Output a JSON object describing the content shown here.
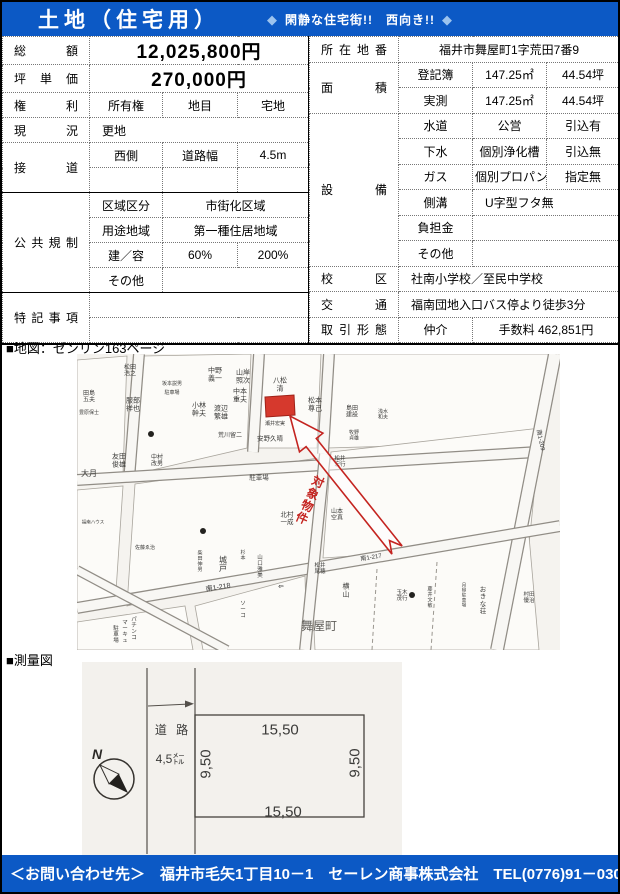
{
  "colors": {
    "banner": "#0c59c5",
    "tagline_diamond": "#9cc3ee",
    "highlight_red": "#d6392d",
    "arrow_red": "#c42420"
  },
  "header": {
    "title": "土地（住宅用）",
    "diamond_left": "◆",
    "tagline": "閑静な住宅街!!　西向き!!",
    "diamond_right": "◆"
  },
  "left_table": {
    "price_label": "総額",
    "price": "12,025,800円",
    "unit_label": "坪単価",
    "unit": "270,000円",
    "rights_label": "権利",
    "rights": "所有権",
    "landcat_label": "地目",
    "landcat": "宅地",
    "status_label": "現況",
    "status": "更地",
    "road_label": "接道",
    "road_side": "西側",
    "road_width_label": "道路幅",
    "road_width": "4.5m",
    "regulation_label": "公共規制",
    "zoning_label": "区域区分",
    "zoning": "市街化区域",
    "use_label": "用途地域",
    "use": "第一種住居地域",
    "bcr_far_label": "建／容",
    "bcr": "60%",
    "far": "200%",
    "other_label": "その他",
    "notes_label": "特記事項"
  },
  "right_table": {
    "address_label": "所在地番",
    "address": "福井市舞屋町1字荒田7番9",
    "area_label": "面積",
    "registered_label": "登記簿",
    "registered_m2": "147.25㎡",
    "registered_tsubo": "44.54坪",
    "measured_label": "実測",
    "measured_m2": "147.25㎡",
    "measured_tsubo": "44.54坪",
    "facilities_label": "設備",
    "water_label": "水道",
    "water": "公営",
    "water_status": "引込有",
    "sewer_label": "下水",
    "sewer": "個別浄化槽",
    "sewer_status": "引込無",
    "gas_label": "ガス",
    "gas": "個別プロパン",
    "gas_status": "指定無",
    "gutter_label": "側溝",
    "gutter": "U字型フタ無",
    "burden_label": "負担金",
    "other_label": "その他",
    "school_label": "校区",
    "school": "社南小学校／至民中学校",
    "transit_label": "交通",
    "transit": "福南団地入口バス停より徒歩3分",
    "deal_label": "取引形態",
    "deal_type": "仲介",
    "fee": "手数料 462,851円"
  },
  "map_section": {
    "heading": "■地図：ゼンリン163ページ",
    "map": {
      "bg": "#f5f3ef",
      "blocks": [
        [
          0,
          6,
          50,
          2,
          46,
          120,
          0,
          128
        ],
        [
          66,
          2,
          174,
          0,
          170,
          94,
          58,
          120
        ],
        [
          186,
          0,
          244,
          0,
          240,
          94,
          178,
          94
        ],
        [
          256,
          0,
          472,
          0,
          458,
          88,
          250,
          94
        ],
        [
          0,
          136,
          46,
          132,
          38,
          252,
          0,
          258
        ],
        [
          58,
          130,
          242,
          104,
          236,
          208,
          50,
          252
        ],
        [
          254,
          98,
          464,
          74,
          452,
          190,
          246,
          204
        ],
        [
          234,
          214,
          452,
          182,
          462,
          296,
          238,
          296
        ],
        [
          118,
          252,
          228,
          222,
          230,
          296,
          126,
          296
        ],
        [
          0,
          268,
          108,
          252,
          116,
          296,
          0,
          296
        ]
      ],
      "roads": [
        [
          62,
          0,
          52,
          126
        ],
        [
          182,
          0,
          176,
          98
        ],
        [
          252,
          0,
          246,
          100
        ],
        [
          0,
          126,
          460,
          98
        ],
        [
          478,
          0,
          420,
          296,
          14
        ],
        [
          0,
          254,
          483,
          172
        ],
        [
          248,
          100,
          228,
          296
        ],
        [
          0,
          216,
          150,
          296,
          10
        ]
      ],
      "dashes": [
        [
          300,
          215,
          295,
          296
        ],
        [
          360,
          208,
          354,
          296
        ]
      ],
      "dots": [
        [
          74,
          80
        ],
        [
          126,
          177
        ],
        [
          335,
          241
        ]
      ],
      "parcel": [
        188,
        43,
        217,
        41,
        218,
        61,
        189,
        63
      ],
      "arrow_points": "213,62 222.5,97.9 229.1,92.6 314.9,200.1 312.5,186.6 325.1,191.9 239.3,84.5 245.9,79.2",
      "arrow_label": {
        "t": "対象物件",
        "x": 233,
        "y": 146,
        "r": 24,
        "s": 12
      },
      "labels": [
        {
          "t": "松田\n浩之",
          "x": 53,
          "y": 16,
          "s": 6
        },
        {
          "t": "坂本説男",
          "x": 95,
          "y": 29,
          "s": 5
        },
        {
          "t": "田島\n五夫",
          "x": 12,
          "y": 42,
          "s": 6
        },
        {
          "t": "服部\n祥也",
          "x": 56,
          "y": 50,
          "s": 7
        },
        {
          "t": "豊原保士",
          "x": 12,
          "y": 58,
          "s": 5
        },
        {
          "t": "駐車場",
          "x": 95,
          "y": 38,
          "s": 5
        },
        {
          "t": "中野\n義一",
          "x": 138,
          "y": 20,
          "s": 7
        },
        {
          "t": "山岸\n照次",
          "x": 166,
          "y": 22,
          "s": 7
        },
        {
          "t": "中本\n重夫",
          "x": 163,
          "y": 41,
          "s": 7
        },
        {
          "t": "小林\n幹夫",
          "x": 122,
          "y": 55,
          "s": 7
        },
        {
          "t": "渡辺\n繁雄",
          "x": 144,
          "y": 58,
          "s": 7
        },
        {
          "t": "荒川留二",
          "x": 153,
          "y": 81,
          "s": 6
        },
        {
          "t": "八松\n清",
          "x": 203,
          "y": 30,
          "s": 7
        },
        {
          "t": "松本\n尊己",
          "x": 238,
          "y": 50,
          "s": 7
        },
        {
          "t": "瀬井宏実",
          "x": 198,
          "y": 69,
          "s": 5
        },
        {
          "t": "安野久晴",
          "x": 193,
          "y": 84,
          "s": 6.5
        },
        {
          "t": "島田\n建設",
          "x": 275,
          "y": 57,
          "s": 6
        },
        {
          "t": "浅水\n和夫",
          "x": 306,
          "y": 60,
          "s": 5
        },
        {
          "t": "牧野\n貞雄",
          "x": 277,
          "y": 81,
          "s": 5
        },
        {
          "t": "松井\n宏行",
          "x": 263,
          "y": 107,
          "s": 5.5
        },
        {
          "t": "友田\n俊雄",
          "x": 42,
          "y": 106,
          "s": 7
        },
        {
          "t": "中村\n改男",
          "x": 80,
          "y": 106,
          "s": 6
        },
        {
          "t": "大月",
          "x": 12,
          "y": 119,
          "s": 8
        },
        {
          "t": "駐車場",
          "x": 182,
          "y": 123,
          "s": 6.5
        },
        {
          "t": "山本\n空真",
          "x": 260,
          "y": 160,
          "s": 6
        },
        {
          "t": "北村\n一成",
          "x": 210,
          "y": 164,
          "s": 6.5
        },
        {
          "t": "福南ハウス",
          "x": 16,
          "y": 168,
          "s": 4.5
        },
        {
          "t": "佐藤ゑ治",
          "x": 68,
          "y": 193,
          "s": 5
        },
        {
          "t": "柴田伸男",
          "x": 123,
          "y": 207,
          "s": 5,
          "v": true
        },
        {
          "t": "城戸",
          "x": 146,
          "y": 210,
          "s": 8,
          "v": true
        },
        {
          "t": "杉本",
          "x": 166,
          "y": 201,
          "s": 5,
          "v": true
        },
        {
          "t": "山口雅美",
          "x": 183,
          "y": 212,
          "s": 5.5,
          "v": true
        },
        {
          "t": "松井\n尾穂",
          "x": 243,
          "y": 214,
          "s": 5.5
        },
        {
          "t": "横山",
          "x": 269,
          "y": 236,
          "s": 7,
          "v": true
        },
        {
          "t": "玉木\n茂行",
          "x": 325,
          "y": 241,
          "s": 5.5
        },
        {
          "t": "藤井文敏",
          "x": 353,
          "y": 243,
          "s": 5,
          "v": true
        },
        {
          "t": "月極駐車場",
          "x": 387,
          "y": 241,
          "s": 4.5,
          "v": true
        },
        {
          "t": "おきな荘",
          "x": 406,
          "y": 246,
          "s": 6.5,
          "v": true
        },
        {
          "t": "村田\n優治",
          "x": 452,
          "y": 243,
          "s": 5.5
        },
        {
          "t": "舞屋町",
          "x": 242,
          "y": 272,
          "s": 12,
          "c": "#5f5d59"
        },
        {
          "t": "南1-218",
          "x": 141,
          "y": 233,
          "s": 7,
          "r": -9,
          "c": "#333333"
        },
        {
          "t": "南1-217",
          "x": 294,
          "y": 203,
          "s": 6,
          "r": -9,
          "c": "#333333"
        },
        {
          "t": "南1-209",
          "x": 464,
          "y": 86,
          "s": 6,
          "r": 78,
          "c": "#333333"
        },
        {
          "t": "ソーコ",
          "x": 166,
          "y": 255,
          "s": 5.5,
          "v": true
        },
        {
          "t": "パチンコ",
          "x": 57,
          "y": 274,
          "s": 5.5,
          "v": true
        },
        {
          "t": "マーキュ",
          "x": 48,
          "y": 277,
          "s": 5.5,
          "v": true
        },
        {
          "t": "駐車場",
          "x": 39,
          "y": 280,
          "s": 5.5,
          "v": true
        },
        {
          "t": "⇐",
          "x": 204,
          "y": 232,
          "s": 7,
          "r": -9,
          "c": "#333333"
        }
      ]
    }
  },
  "survey_section": {
    "heading": "■測量図",
    "survey": {
      "bg": "#f3f1ed",
      "north_label": "N",
      "road_label": "道 路",
      "road_width": "4,5㍍",
      "dim_top": "15,50",
      "dim_bottom": "15,50",
      "dim_left": "9,50",
      "dim_right": "9,50"
    }
  },
  "footer": {
    "contact": "＜お問い合わせ先＞　福井市毛矢1丁目10－1　セーレン商事株式会社　TEL(0776)91－0303"
  }
}
